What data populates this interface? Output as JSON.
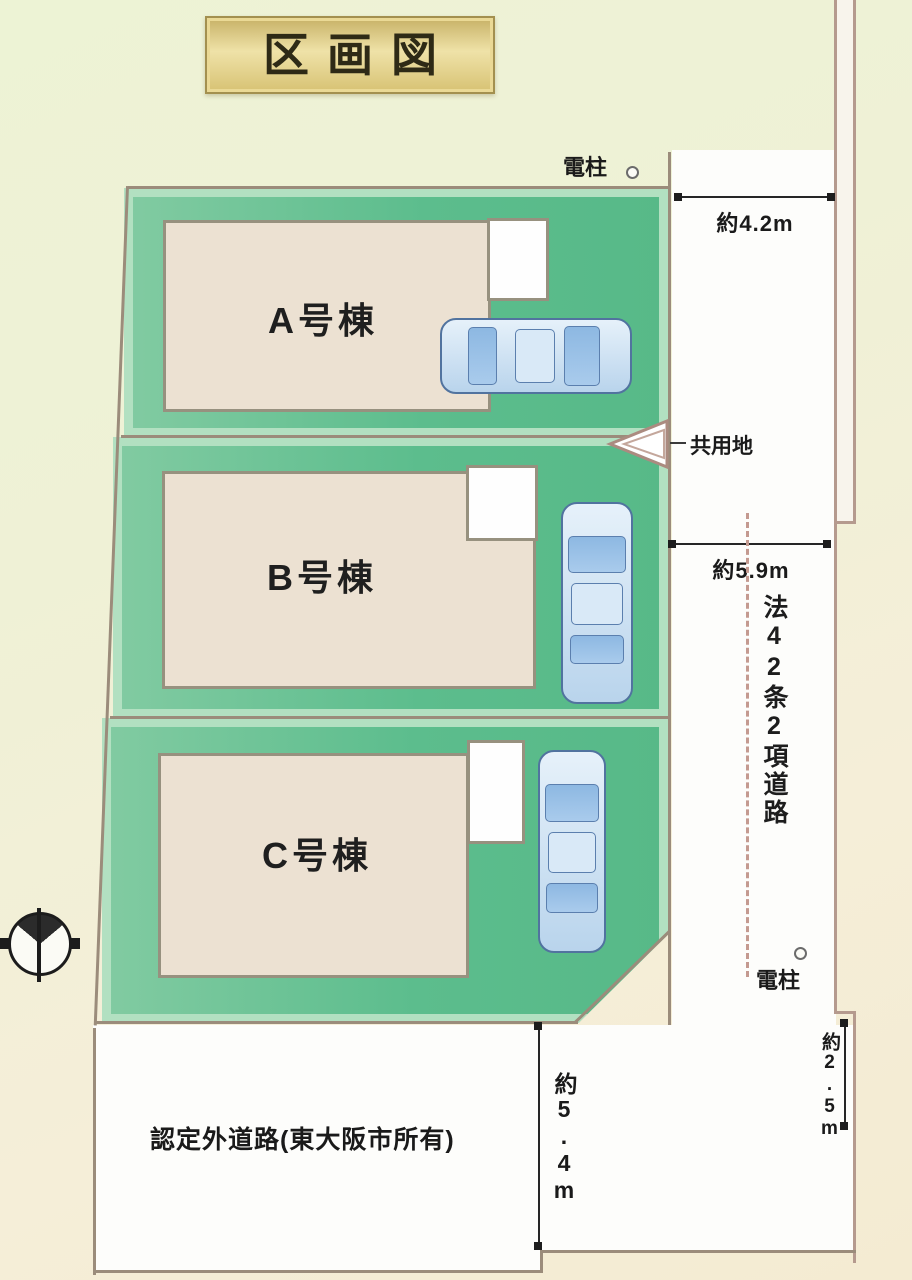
{
  "title": "区画図",
  "lots": [
    {
      "id": "A",
      "label": "A号棟"
    },
    {
      "id": "B",
      "label": "B号棟"
    },
    {
      "id": "C",
      "label": "C号棟"
    }
  ],
  "dimensions": {
    "east_road_top_width": "約4.2m",
    "east_road_mid_width": "約5.9m",
    "east_road_bottom_width": "約2.5m",
    "south_road_width": "約5.4m"
  },
  "labels": {
    "utility_pole_top": "電柱",
    "utility_pole_bottom": "電柱",
    "shared_area": "共用地",
    "east_road_name": "法42条2項道路",
    "south_road_name": "認定外道路(東大阪市所有)"
  },
  "colors": {
    "lot_green": "#5cbd8d",
    "lot_green_light": "#b2e0c1",
    "building_beige": "#ece1d2",
    "road_white": "#fdfdfb",
    "boundary_line": "#9b8c7b",
    "title_gold": "#d7c273",
    "car_blue": "#b9d4ec",
    "dashed_pink": "#c49a90"
  }
}
